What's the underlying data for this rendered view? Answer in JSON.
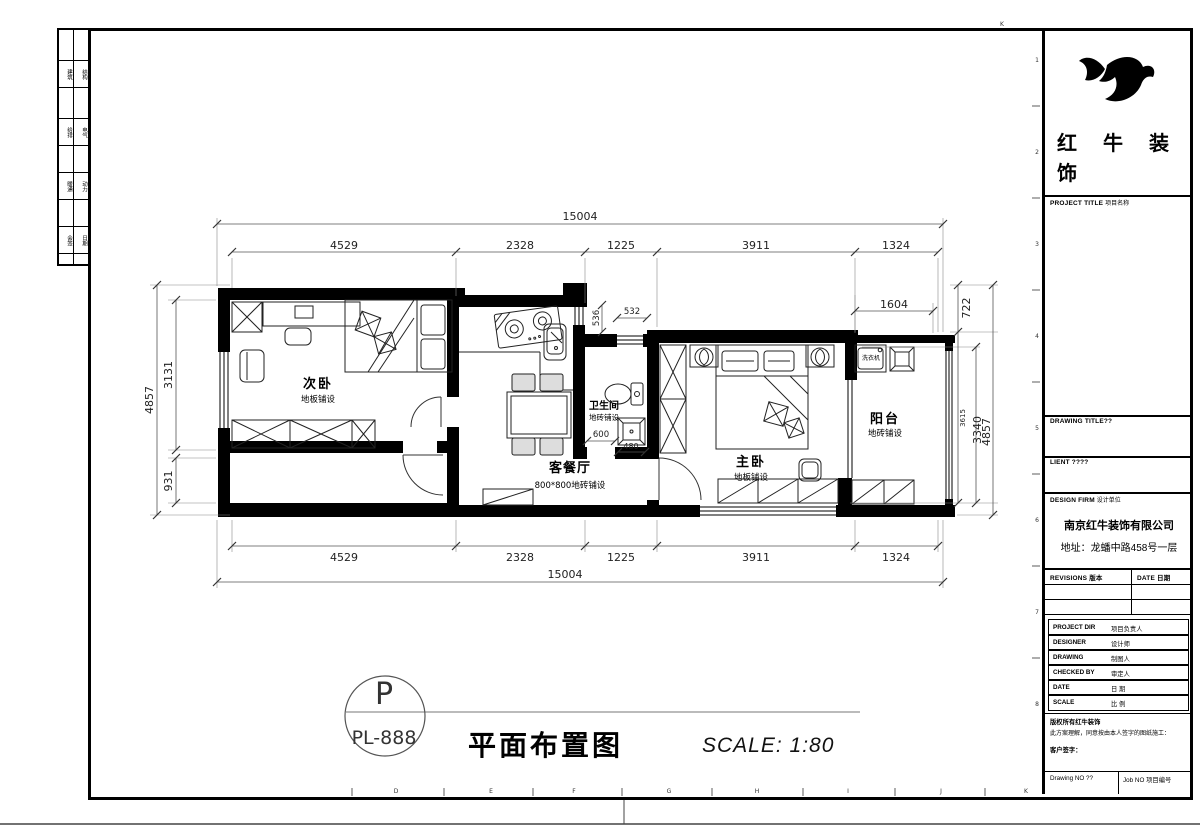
{
  "title_bar": {
    "bubble_letter": "P",
    "bubble_code": "PL-888",
    "title": "平面布置图",
    "scale": "SCALE: 1:80"
  },
  "plan": {
    "rooms": [
      {
        "name": "次卧",
        "finish": "地板铺设"
      },
      {
        "name": "客餐厅",
        "finish": "800*800地砖铺设"
      },
      {
        "name": "卫生间",
        "finish": "地砖铺设"
      },
      {
        "name": "主卧",
        "finish": "地板铺设"
      },
      {
        "name": "阳台",
        "finish": "地砖铺设"
      }
    ],
    "washer_label": "洗衣机",
    "dims": {
      "top_total": "15004",
      "bottom_total": "15004",
      "segments": [
        "4529",
        "2328",
        "1225",
        "3911",
        "1324"
      ],
      "left_total": "4857",
      "left_upper": "3131",
      "left_lower": "931",
      "right_top": "722",
      "right_a": "3615",
      "right_b": "3340",
      "right_total": "4857",
      "balcony": "1604",
      "bath_v": "536",
      "bath_h": "532",
      "bath_door": "600",
      "drain": "480"
    }
  },
  "title_block": {
    "logo_line1": "红牛装",
    "logo_line2": "饰",
    "project_title_en": "PROJECT TITLE",
    "project_title_cn": "项目名称",
    "drawing_title_label": "DRAWING TITLE??",
    "client_label": "LIENT ????",
    "design_firm_en": "DESIGN FIRM",
    "design_firm_cn": "设计单位",
    "company_name": "南京红牛装饰有限公司",
    "company_address": "地址：龙蟠中路458号一层",
    "revisions_label": "REVISIONS  版本",
    "date_col_label": "DATE  日期",
    "rows": [
      {
        "en": "PROJECT DIR",
        "cn": "项目负责人"
      },
      {
        "en": "DESIGNER",
        "cn": "设计师"
      },
      {
        "en": "DRAWING",
        "cn": "制图人"
      },
      {
        "en": "CHECKED BY",
        "cn": "审定人"
      },
      {
        "en": "DATE",
        "cn": "日 期"
      },
      {
        "en": "SCALE",
        "cn": "比 例"
      }
    ],
    "copyright_line1": "版权所有红牛装饰",
    "copyright_line2": "此方案理解，同意按由本人签字的图纸施工：",
    "customer_sign_label": "客户签字：",
    "drawing_no_label": "Drawing NO ??",
    "job_no_label": "Job NO  项目编号"
  },
  "sheet": {
    "grid_letters": [
      "D",
      "E",
      "F",
      "G",
      "H",
      "I",
      "J",
      "K"
    ],
    "grid_numbers": [
      "1",
      "2",
      "3",
      "4",
      "5",
      "6",
      "7",
      "8"
    ],
    "corner_letter": "K",
    "strip_rows": [
      [
        "建筑",
        "结构"
      ],
      [
        "给排",
        "电气"
      ],
      [
        "暖通",
        "动力"
      ],
      [
        "会签",
        "日期"
      ]
    ]
  }
}
